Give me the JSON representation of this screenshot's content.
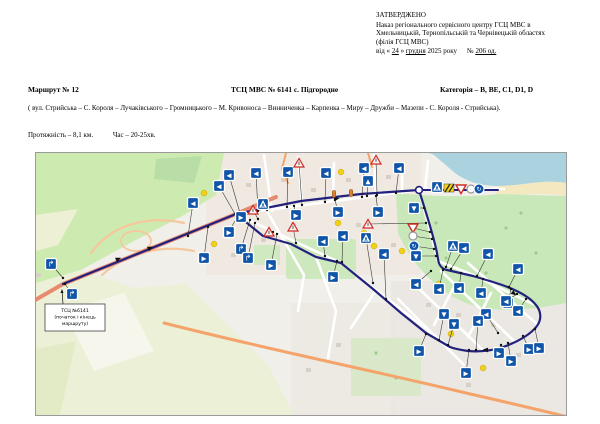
{
  "approved": {
    "title": "ЗАТВЕРДЖЕНО",
    "body": [
      "Наказ  регіонального сервісного центру ГСЦ МВС в",
      "Хмельницькій, Тернопільській та Чернівецькій областях",
      "(філія ГСЦ МВС)"
    ],
    "date": {
      "p1": "від « ",
      "day": "24",
      "p2": " » ",
      "month": "грудня",
      "p3": " 2025 року",
      "p4": "№ ",
      "num": "206 од."
    }
  },
  "titlerow": {
    "route": "Маршрут № 12",
    "center": "ТСЦ МВС № 6141 с. Підгородне",
    "category": "Категорія – B, BE, C1, D1, D"
  },
  "description": "( вул. Стрийська – С. Короля – Лучаківського – Громницького – М. Кривоноса – Винниченка – Карпенка – Миру – Дружби – Мазепи - С. Короля - Стрийська).",
  "metrics": {
    "length": "Протяжність – 8,1 км.",
    "time": "Час – 20-25хв."
  },
  "map": {
    "colors": {
      "route": "#22227e",
      "sign_blue": "#1055a8",
      "warn_red": "#cf2b26",
      "yellow_dot": "#f2d018",
      "signal_orange": "#e08030",
      "leader": "#1a1a1a"
    },
    "start_label": {
      "lines": [
        "ТСЦ №6141",
        "(початок і кінець",
        "маршруту)"
      ],
      "box": [
        9,
        151,
        60,
        27
      ]
    },
    "route_main": "M27,131 L200,61 L265,48 L325,41 L383,37 C389,57 397,80 401,100 L402,106 C403,113 406,116 411,117 L437,123 L457,129 C477,135 493,143 500,152 C505,158 506,166 501,173 C495,181 482,189 467,194 C455,198 443,199 432,198 C425,197 419,196 414,194 L390,180 L365,160 L337,136 L305,110 L280,104 L255,91 L227,83 L200,61",
    "route_spur": "M383,37 L462,37",
    "roundabout_node": [
      383,
      37
    ],
    "signals": [
      [
        298,
        41
      ],
      [
        315,
        40
      ]
    ],
    "yellow_dots": [
      [
        305,
        19
      ],
      [
        302,
        70
      ],
      [
        328,
        80
      ],
      [
        178,
        91
      ],
      [
        168,
        40
      ],
      [
        403,
        131
      ],
      [
        415,
        181
      ],
      [
        447,
        215
      ],
      [
        338,
        93
      ],
      [
        366,
        98
      ]
    ],
    "dir_arrows": [
      [
        80,
        107,
        -24
      ],
      [
        298,
        46,
        -8
      ],
      [
        476,
        139,
        38
      ],
      [
        452,
        197,
        183
      ],
      [
        112,
        96,
        -24
      ]
    ],
    "signs": [
      [
        15,
        111,
        "tr",
        27,
        125
      ],
      [
        36,
        141,
        "tr",
        29,
        131
      ],
      [
        157,
        50,
        "l",
        152,
        83
      ],
      [
        183,
        33,
        "l",
        199,
        61
      ],
      [
        193,
        22,
        "l",
        204,
        60
      ],
      [
        220,
        20,
        "l",
        222,
        58
      ],
      [
        252,
        19,
        "l",
        251,
        54
      ],
      [
        290,
        20,
        "l",
        289,
        49
      ],
      [
        328,
        15,
        "l",
        326,
        44
      ],
      [
        363,
        15,
        "l",
        360,
        40
      ],
      [
        332,
        28,
        "u",
        331,
        43
      ],
      [
        302,
        59,
        "r",
        299,
        47
      ],
      [
        342,
        59,
        "r",
        340,
        43
      ],
      [
        260,
        62,
        "r",
        258,
        53
      ],
      [
        227,
        51,
        "ped",
        231,
        57
      ],
      [
        205,
        64,
        "r",
        207,
        61
      ],
      [
        193,
        79,
        "r",
        201,
        64
      ],
      [
        263,
        10,
        "warn",
        266,
        52
      ],
      [
        340,
        7,
        "warn",
        341,
        42
      ],
      [
        217,
        57,
        "warn",
        222,
        66
      ],
      [
        233,
        79,
        "warn",
        237,
        79
      ],
      [
        257,
        74,
        "warn",
        260,
        90
      ],
      [
        205,
        96,
        "tr",
        214,
        67
      ],
      [
        212,
        105,
        "tr",
        219,
        70
      ],
      [
        168,
        105,
        "r",
        172,
        74
      ],
      [
        235,
        112,
        "r",
        241,
        81
      ],
      [
        297,
        124,
        "r",
        301,
        108
      ],
      [
        287,
        88,
        "l",
        289,
        103
      ],
      [
        307,
        83,
        "l",
        306,
        109
      ],
      [
        378,
        55,
        "d",
        388,
        55
      ],
      [
        332,
        71,
        "warn",
        390,
        70
      ],
      [
        377,
        75,
        "yield",
        394,
        79
      ],
      [
        377,
        83,
        "circ",
        396,
        86
      ],
      [
        330,
        85,
        "ped",
        337,
        130
      ],
      [
        378,
        93,
        "rnd",
        398,
        96
      ],
      [
        348,
        101,
        "l",
        350,
        146
      ],
      [
        380,
        103,
        "d",
        400,
        103
      ],
      [
        401,
        34,
        "ped",
        400,
        37
      ],
      [
        413,
        35,
        "hz",
        412,
        37
      ],
      [
        425,
        36,
        "yield",
        424,
        37
      ],
      [
        435,
        36,
        "circ",
        434,
        37
      ],
      [
        443,
        36,
        "rnd",
        442,
        37
      ],
      [
        417,
        93,
        "ped",
        410,
        114
      ],
      [
        428,
        95,
        "l",
        415,
        116
      ],
      [
        452,
        101,
        "l",
        441,
        123
      ],
      [
        482,
        116,
        "l",
        473,
        134
      ],
      [
        380,
        131,
        "l",
        395,
        118
      ],
      [
        403,
        136,
        "l",
        407,
        117
      ],
      [
        423,
        135,
        "l",
        425,
        120
      ],
      [
        445,
        140,
        "l",
        447,
        126
      ],
      [
        472,
        150,
        "l",
        475,
        136
      ],
      [
        482,
        158,
        "l",
        490,
        146
      ],
      [
        450,
        161,
        "l",
        462,
        180
      ],
      [
        470,
        148,
        "l",
        481,
        141
      ],
      [
        408,
        161,
        "d",
        403,
        187
      ],
      [
        418,
        171,
        "d",
        412,
        192
      ],
      [
        442,
        168,
        "l",
        440,
        197
      ],
      [
        383,
        198,
        "r",
        390,
        181
      ],
      [
        430,
        220,
        "r",
        433,
        197
      ],
      [
        463,
        200,
        "r",
        465,
        192
      ],
      [
        475,
        208,
        "r",
        472,
        190
      ],
      [
        493,
        196,
        "r",
        487,
        183
      ],
      [
        503,
        195,
        "r",
        499,
        176
      ]
    ]
  }
}
